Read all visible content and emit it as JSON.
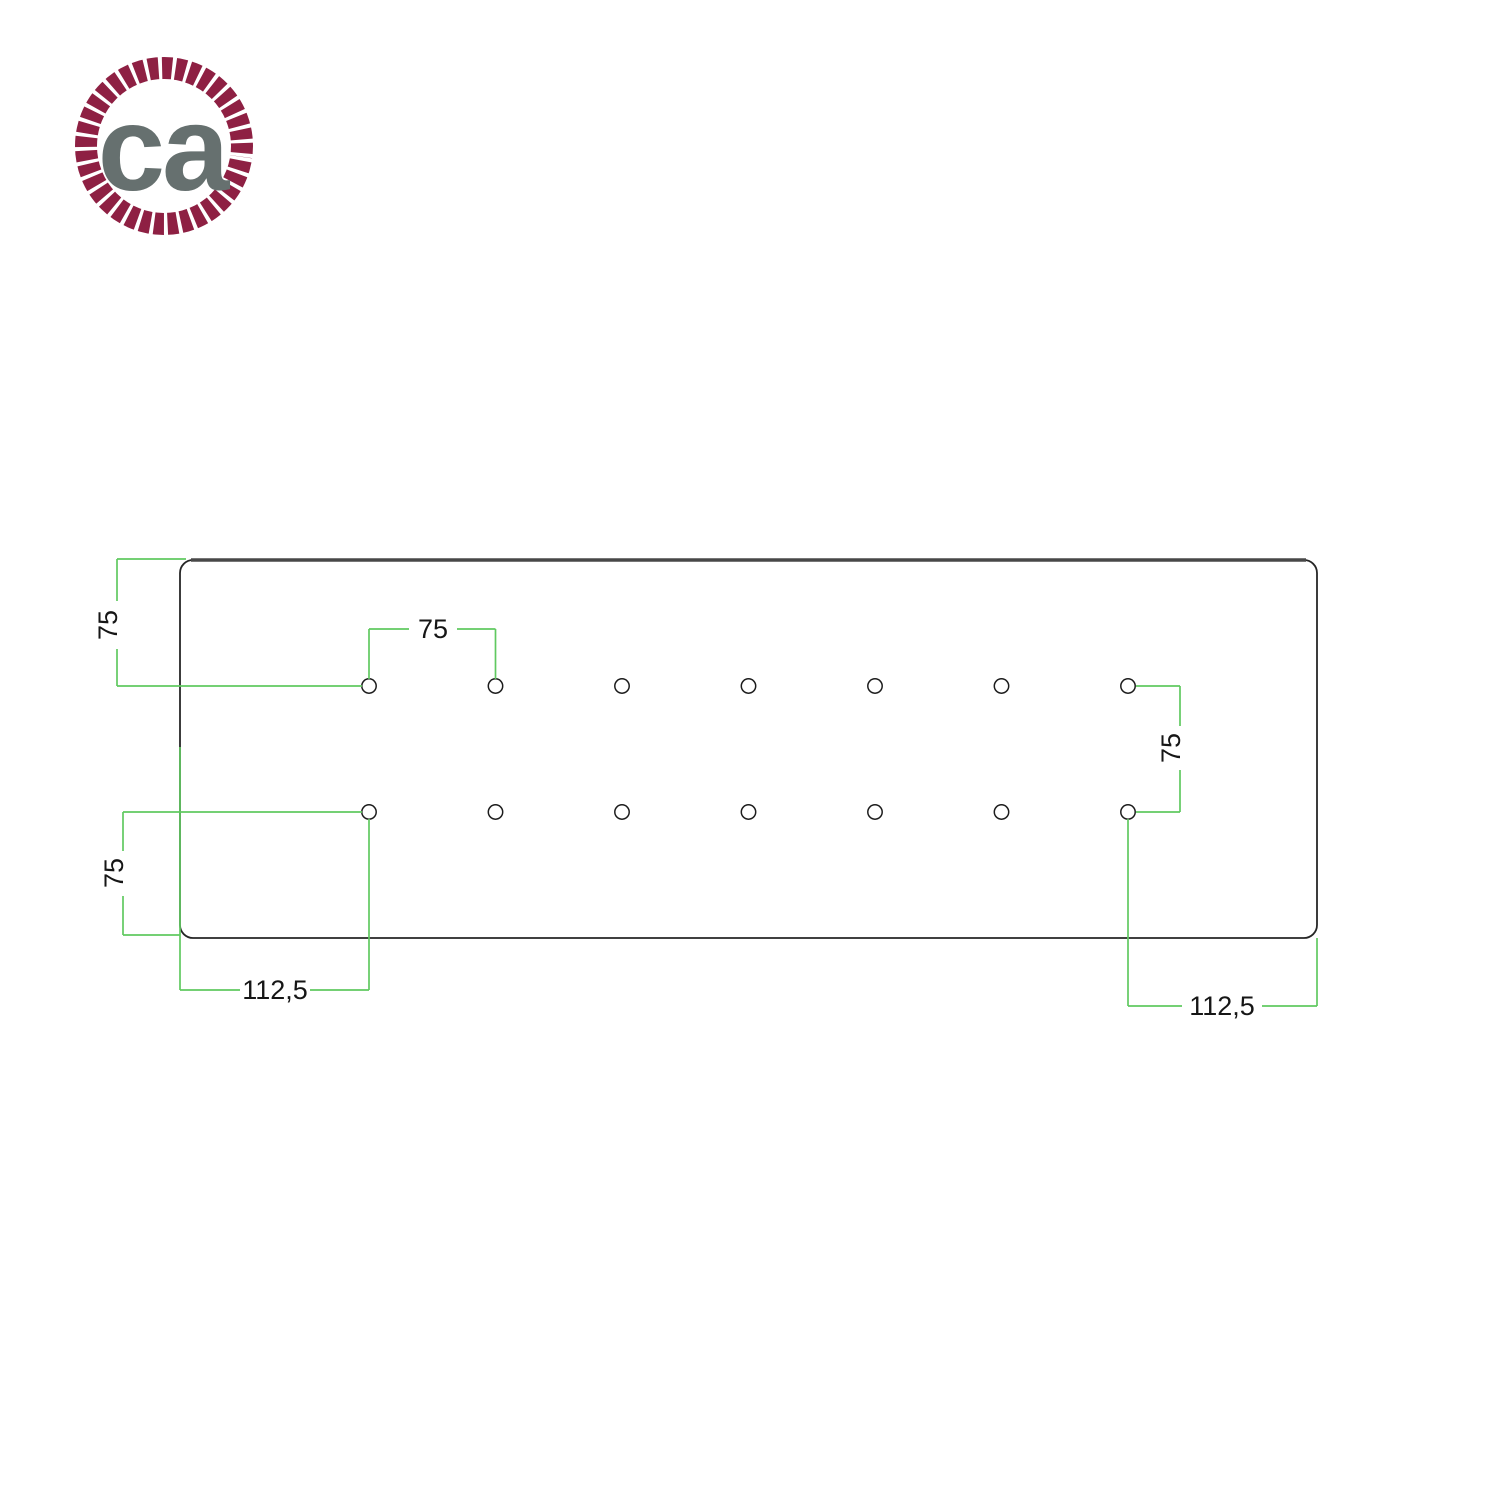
{
  "page": {
    "background_color": "#ffffff",
    "kind": "technical drawing of rectangular ceiling rose mounting plate with hole pattern"
  },
  "logo": {
    "text": "ca",
    "text_color": "#66706f",
    "ring_color": "#8e2043",
    "name": "creative-cables rope logo"
  },
  "drawing": {
    "dimension_color": "#60c960",
    "outline_color": "#262626",
    "plate": {
      "shape": "rounded-rectangle",
      "hole_rows": 2,
      "hole_columns": 7,
      "hole_count": 14
    },
    "hole_grid": {
      "col_x": [
        369,
        495.5,
        622,
        748.5,
        875,
        1001.5,
        1128
      ],
      "row_y": [
        686,
        812
      ],
      "radius": 7.2
    },
    "labels": {
      "top_left_vertical": "75",
      "top_horizontal": "75",
      "right_vertical": "75",
      "left_lower_vertical": "75",
      "bottom_left_horizontal": "112,5",
      "bottom_right_horizontal": "112,5"
    }
  }
}
